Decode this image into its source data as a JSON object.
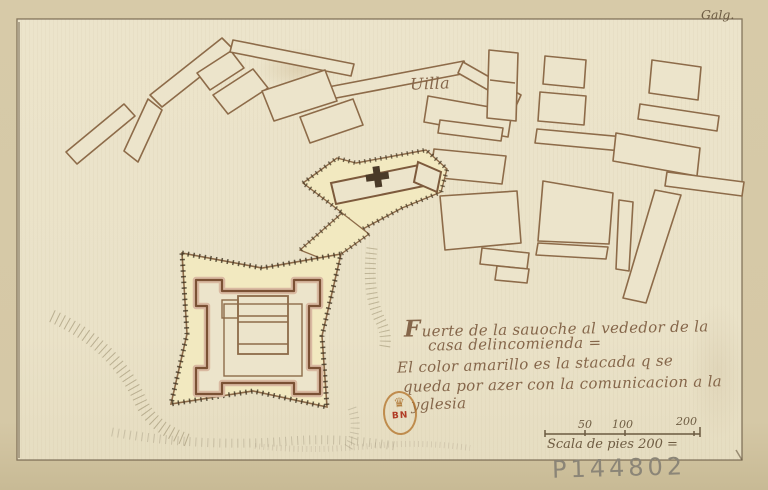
{
  "frame": {
    "archive_mark": "Galg."
  },
  "labels": {
    "villa": "Uilla"
  },
  "caption": {
    "initial": "F",
    "line1_rest": "uerte de la sauoche al vededor de la",
    "line2": "casa delincomienda =",
    "line3": "El color amarillo es la stacada q se",
    "line4": "queda por azer con la comunicacion a la",
    "line5": "yglesia"
  },
  "scale_bar": {
    "ticks": [
      "50",
      "100",
      "200"
    ],
    "label": "Scala de pies 200 ="
  },
  "stamp": {
    "letters": "BN",
    "crown_icon": "crown"
  },
  "annotations": {
    "shelfmark": "P144802"
  },
  "colors": {
    "paper_margin": "#d5c8a6",
    "paper_sheet": "#ebe3c9",
    "ink_brown": "#8d6b49",
    "ink_dark": "#584733",
    "stockade_yellow": "#f2e9c0",
    "wall_red": "#7b5134",
    "stamp_gold": "#b5772f",
    "stamp_red": "#b03a24",
    "pencil_gray": "#8b8577"
  }
}
